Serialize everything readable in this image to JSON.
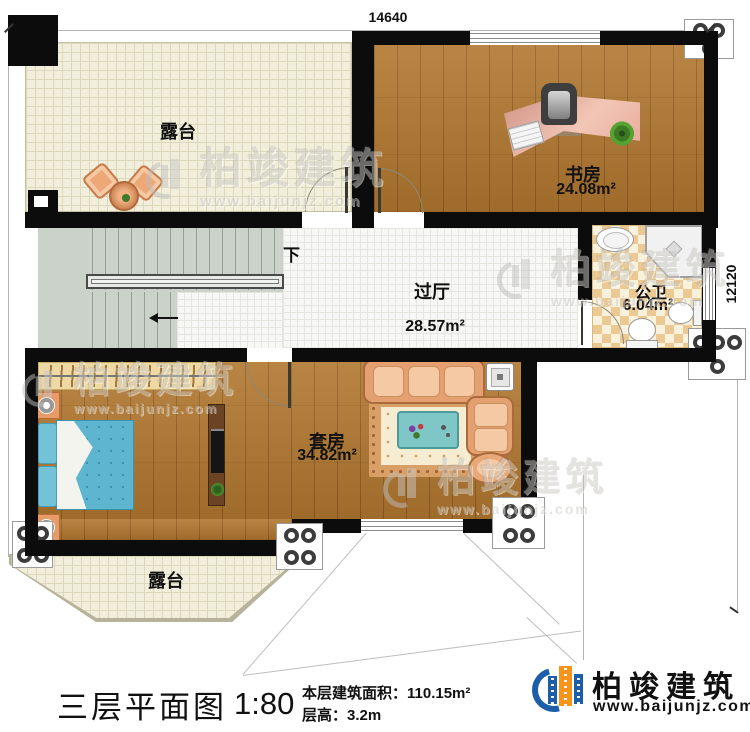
{
  "plan": {
    "dim_top": "14640",
    "dim_right": "12120",
    "stairs_down": "下",
    "rooms": {
      "terrace_top": {
        "label": "露台"
      },
      "study": {
        "label": "书房",
        "area": "24.08m²"
      },
      "hall": {
        "label": "过厅",
        "area": "28.57m²"
      },
      "bath": {
        "label": "公卫",
        "area": "6.04m²"
      },
      "suite": {
        "label": "套房",
        "area": "34.82m²"
      },
      "terrace_bottom": {
        "label": "露台"
      }
    }
  },
  "caption": {
    "title": "三层平面图",
    "scale": "1:80",
    "area": "本层建筑面积：110.15m²",
    "floor_height": "层高：3.2m"
  },
  "brand": {
    "name": "柏竣建筑",
    "site": "www.baijunjz.com"
  },
  "watermark": {
    "name": "柏竣建筑",
    "site": "www.baijunjz.com"
  },
  "colors": {
    "wall": "#0c0c0c",
    "wood": "#b1772f",
    "terrace": "#f1efdc",
    "tile": "#f7f7f5",
    "stair": "#cbd2ca",
    "checker": "#ecc992",
    "bed": "#5db5cf",
    "sofa": "#e5a071",
    "brand_blue": "#1c5fa8",
    "brand_orange": "#f7941d"
  }
}
